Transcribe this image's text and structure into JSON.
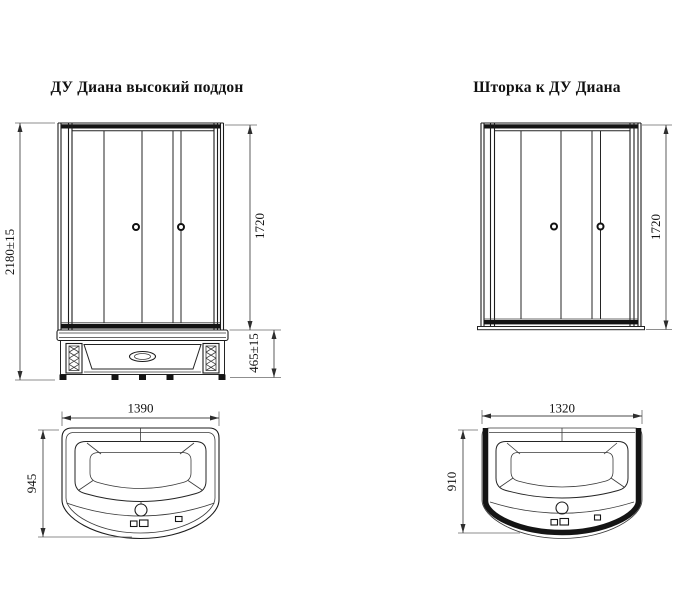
{
  "left": {
    "title": "ДУ Диана высокий поддон",
    "front": {
      "total_height": "2180±15",
      "glass_height": "1720",
      "tray_height": "465±15"
    },
    "top": {
      "width": "1390",
      "depth": "945"
    }
  },
  "right": {
    "title": "Шторка к ДУ Диана",
    "front": {
      "glass_height": "1720"
    },
    "top": {
      "width": "1320",
      "depth": "910"
    }
  },
  "colors": {
    "line": "#1c1c1c",
    "dark_fill": "#141414",
    "dimension_line": "#4a4a4a",
    "text": "#111111",
    "background": "#ffffff"
  }
}
